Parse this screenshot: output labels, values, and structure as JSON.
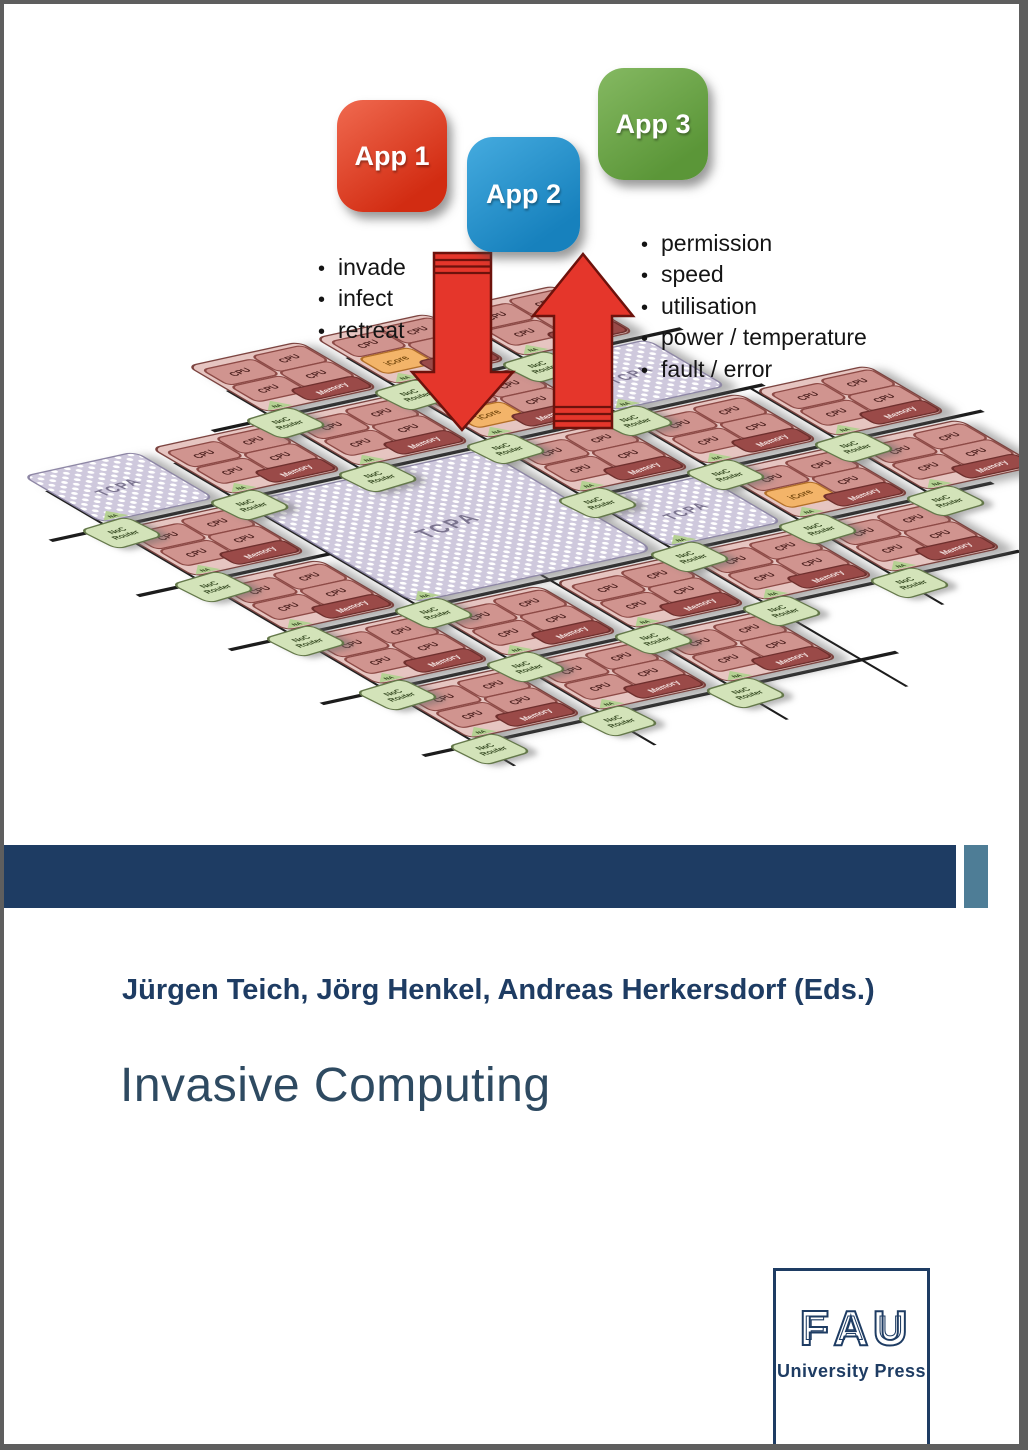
{
  "apps": [
    {
      "label": "App 1",
      "color_light": "#f06a50",
      "color_dark": "#d22c12"
    },
    {
      "label": "App 2",
      "color_light": "#45abdf",
      "color_dark": "#1781bd"
    },
    {
      "label": "App 3",
      "color_light": "#85b962",
      "color_dark": "#5b9638"
    }
  ],
  "legend_left": [
    "invade",
    "infect",
    "retreat"
  ],
  "legend_right": [
    "permission",
    "speed",
    "utilisation",
    "power / temperature",
    "fault / error"
  ],
  "diagram": {
    "labels": {
      "cpu": "CPU",
      "memory": "Memory",
      "icore": "iCore",
      "tcpa": "TCPA",
      "router": [
        "NoC",
        "Router"
      ],
      "na": "NA"
    },
    "tiles": [
      {
        "c": 2,
        "r": -1,
        "type": "cpu"
      },
      {
        "c": 3,
        "r": -1,
        "type": "icore"
      },
      {
        "c": 4,
        "r": -1,
        "type": "cpu"
      },
      {
        "c": 0,
        "r": 0,
        "type": "tcpa"
      },
      {
        "c": 1,
        "r": 0,
        "type": "cpu"
      },
      {
        "c": 2,
        "r": 0,
        "type": "cpu"
      },
      {
        "c": 3,
        "r": 0,
        "type": "icore"
      },
      {
        "c": 4,
        "r": 0,
        "type": "tcpa"
      },
      {
        "c": 0,
        "r": 1,
        "type": "cpu"
      },
      {
        "c": 1,
        "r": 1,
        "type": "tcpa_big"
      },
      {
        "c": 3,
        "r": 1,
        "type": "cpu"
      },
      {
        "c": 4,
        "r": 1,
        "type": "cpu"
      },
      {
        "c": 5,
        "r": 1,
        "type": "cpu"
      },
      {
        "c": 0,
        "r": 2,
        "type": "cpu"
      },
      {
        "c": 3,
        "r": 2,
        "type": "tcpa"
      },
      {
        "c": 4,
        "r": 2,
        "type": "icore"
      },
      {
        "c": 5,
        "r": 2,
        "type": "cpu"
      },
      {
        "c": 0,
        "r": 3,
        "type": "cpu"
      },
      {
        "c": 1,
        "r": 3,
        "type": "cpu"
      },
      {
        "c": 2,
        "r": 3,
        "type": "cpu"
      },
      {
        "c": 3,
        "r": 3,
        "type": "cpu"
      },
      {
        "c": 4,
        "r": 3,
        "type": "cpu"
      },
      {
        "c": 0,
        "r": 4,
        "type": "cpu"
      },
      {
        "c": 1,
        "r": 4,
        "type": "cpu"
      },
      {
        "c": 2,
        "r": 4,
        "type": "cpu"
      }
    ]
  },
  "cover": {
    "authors": "Jürgen Teich, Jörg Henkel, Andreas Herkersdorf (Eds.)",
    "title": "Invasive Computing",
    "publisher": {
      "wordmark": "FAU",
      "name": "University Press"
    }
  },
  "colors": {
    "navy": "#1e3c63",
    "teal": "#4e7d96",
    "frame": "#5e5e5e",
    "title_text": "#2e4a61",
    "arrow_red": "#e5362b",
    "arrow_outline": "#6d120c",
    "line": "#1c1c1c",
    "tile_bg": "#e6c5c1",
    "tile_border": "#7c4440",
    "cpu_bg": "#d0948f",
    "cpu_border": "#8d4a46",
    "cpu_text": "#4e2220",
    "mem_bg": "#9a4a48",
    "icore_bg": "#f3b469",
    "icore_border": "#b26f28",
    "icore_text": "#7a4d12",
    "tcpa_bg": "#cfc9dd",
    "tcpa_border": "#8e87a5",
    "tcpa_text": "#7b748f",
    "router_bg": "#d3e3b9",
    "router_border": "#64784a",
    "router_text": "#364a22",
    "na_bg": "#b5d193"
  }
}
